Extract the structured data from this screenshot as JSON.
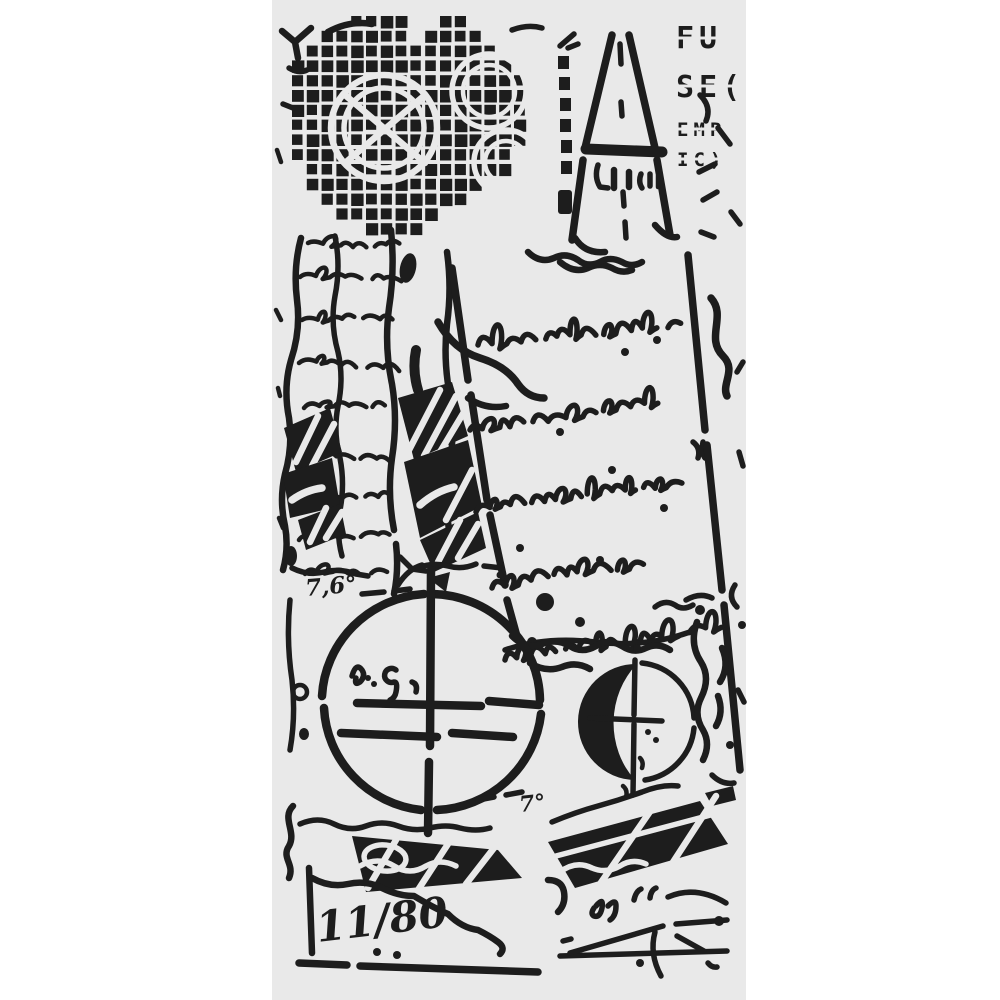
{
  "artwork": {
    "kind": "collage-stencil-sheet",
    "colors": {
      "background": "#ffffff",
      "sheet": "#e9e9e9",
      "ink": "#1d1d1d"
    },
    "text": {
      "corner_line1": "FU",
      "corner_line2": "SE(",
      "corner_line3": "EMP",
      "corner_line4": "IC)",
      "angle_upper": "7,6°",
      "angle_lower": "7°",
      "fraction": "11/80"
    }
  }
}
